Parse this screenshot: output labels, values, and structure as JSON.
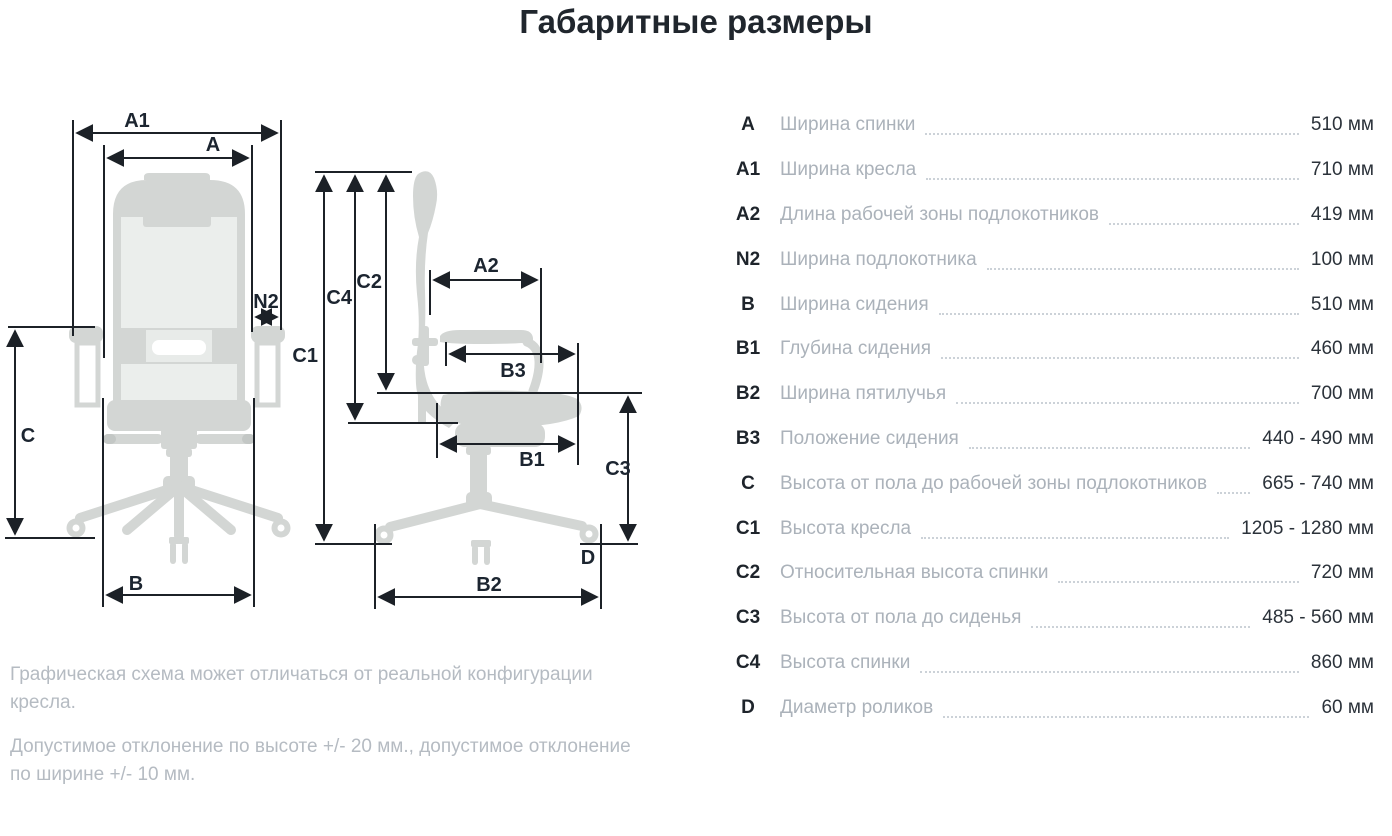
{
  "title": "Габаритные размеры",
  "diagram": {
    "labels": {
      "a": "A",
      "a1": "A1",
      "a2": "A2",
      "n2": "N2",
      "b": "B",
      "b1": "B1",
      "b2": "B2",
      "b3": "B3",
      "c": "C",
      "c1": "C1",
      "c2": "C2",
      "c3": "C3",
      "c4": "C4",
      "d": "D"
    }
  },
  "table": {
    "rows": [
      {
        "key": "A",
        "label": "Ширина спинки",
        "value": "510 мм"
      },
      {
        "key": "A1",
        "label": "Ширина кресла",
        "value": "710 мм"
      },
      {
        "key": "A2",
        "label": "Длина рабочей зоны подлокотников",
        "value": "419 мм"
      },
      {
        "key": "N2",
        "label": "Ширина подлокотника",
        "value": "100 мм"
      },
      {
        "key": "B",
        "label": "Ширина сидения",
        "value": "510 мм"
      },
      {
        "key": "B1",
        "label": "Глубина сидения",
        "value": "460 мм"
      },
      {
        "key": "B2",
        "label": "Ширина пятилучья",
        "value": "700 мм"
      },
      {
        "key": "B3",
        "label": "Положение сидения",
        "value": "440 - 490 мм"
      },
      {
        "key": "C",
        "label": "Высота от пола до рабочей зоны подлокотников",
        "value": "665 - 740 мм"
      },
      {
        "key": "C1",
        "label": "Высота кресла",
        "value": "1205 - 1280 мм"
      },
      {
        "key": "C2",
        "label": "Относительная высота спинки",
        "value": "720 мм"
      },
      {
        "key": "C3",
        "label": "Высота от пола до сиденья",
        "value": "485 - 560 мм"
      },
      {
        "key": "C4",
        "label": "Высота спинки",
        "value": "860 мм"
      },
      {
        "key": "D",
        "label": "Диаметр роликов",
        "value": "60 мм"
      }
    ]
  },
  "notes": [
    "Графическая схема может отличаться от реальной конфигурации кресла.",
    "Допустимое отклонение по высоте +/- 20 мм., допустимое отклонение по ширине +/- 10 мм."
  ],
  "colors": {
    "chair_gray": "#d3d6d4",
    "mesh_gray": "#ebeeec",
    "line_dark": "#1c2127",
    "text_dark": "#2b323a",
    "text_muted": "#abb2ba",
    "leader_dots": "#ccd2d8"
  }
}
